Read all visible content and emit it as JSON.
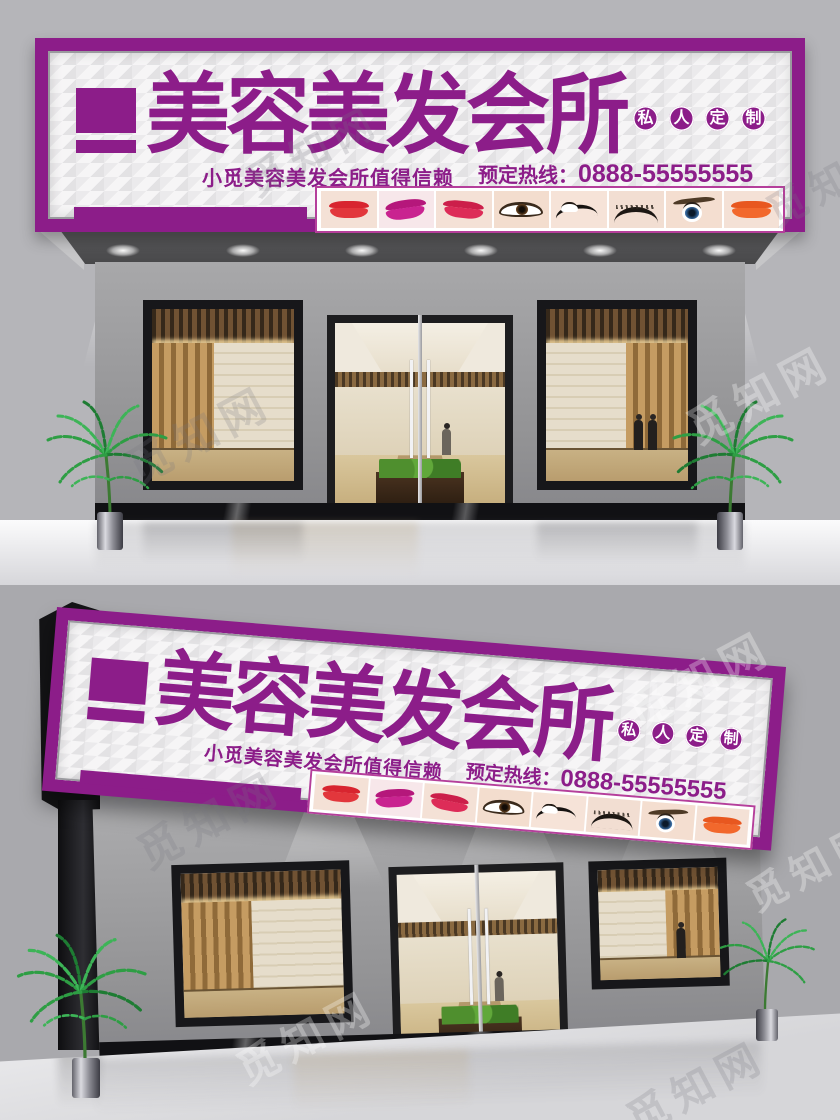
{
  "meta": {
    "watermark_text": "觅知网"
  },
  "palette": {
    "brand_purple": "#8c1d89",
    "strip_border_pink": "#b53f9b",
    "sign_face": "#f6f5f6",
    "top_background": "#b5b5b9",
    "bottom_background": "#a9a9ad"
  },
  "sign": {
    "title": "美容美发会所",
    "badge_text": "私人定制",
    "badge": [
      "私",
      "人",
      "定",
      "制"
    ],
    "tagline": "小觅美容美发会所值得信赖",
    "hotline_label": "预定热线：",
    "hotline_number": "0888-55555555",
    "photos": [
      "red-lips",
      "magenta-lips",
      "crimson-lips",
      "brown-eye",
      "liner-eye",
      "false-lashes",
      "blue-eye",
      "orange-lips"
    ]
  },
  "scenes": [
    {
      "name": "flat storefront mockup"
    },
    {
      "name": "perspective storefront mockup"
    }
  ]
}
